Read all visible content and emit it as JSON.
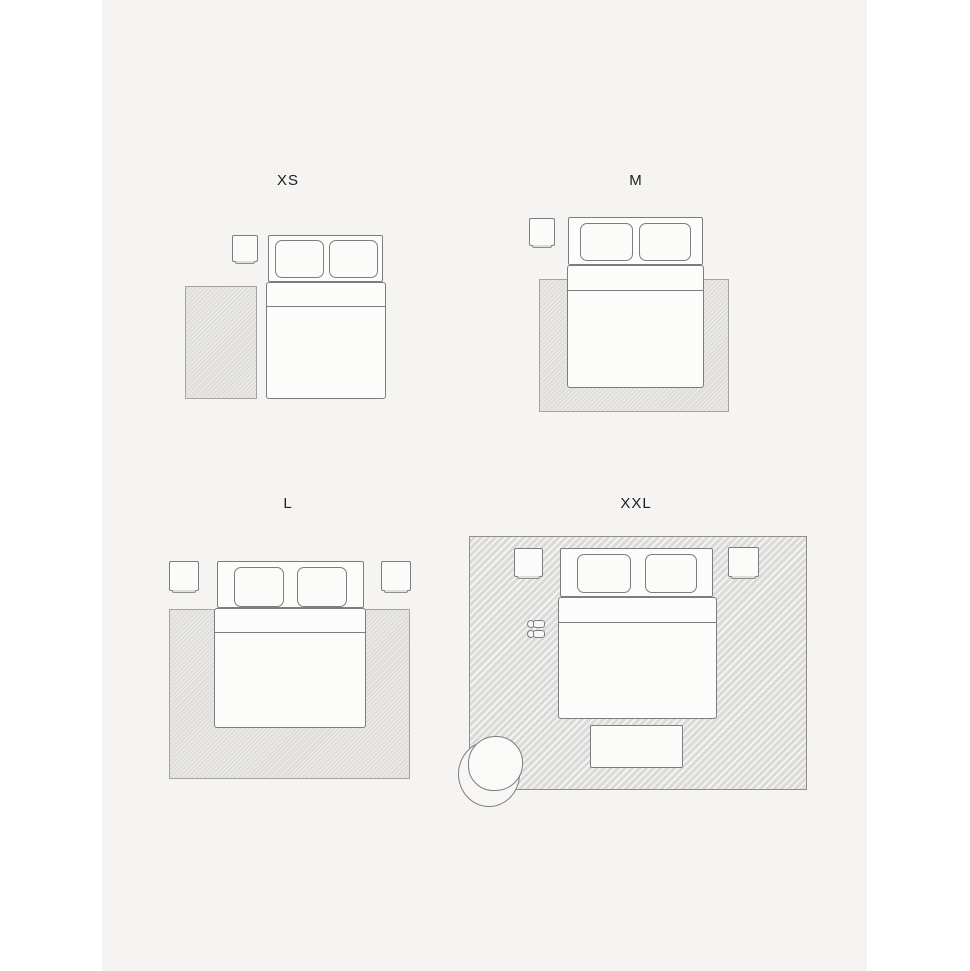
{
  "page": {
    "background": "#ffffff",
    "canvas_background": "#f5f4f2"
  },
  "colors": {
    "outline_gray": "#7d7d7d",
    "rug_fill": "#e2e1df",
    "rug_hatched_fill": "#dfdedc",
    "rug_border": "#a5a4a2",
    "furniture_fill": "#fcfcfb",
    "label_text": "#1f1f1f"
  },
  "layouts": [
    {
      "id": "xs",
      "label": "XS",
      "items": [
        "nightstand",
        "double-bed",
        "bedside-runner-rug"
      ]
    },
    {
      "id": "m",
      "label": "M",
      "items": [
        "nightstand",
        "double-bed",
        "under-bed-rug"
      ]
    },
    {
      "id": "l",
      "label": "L",
      "items": [
        "nightstand",
        "nightstand",
        "double-bed",
        "under-bed-rug"
      ]
    },
    {
      "id": "xxl",
      "label": "XXL",
      "items": [
        "nightstand",
        "nightstand",
        "double-bed",
        "slippers",
        "bench",
        "armchair",
        "room-size-rug"
      ]
    }
  ]
}
